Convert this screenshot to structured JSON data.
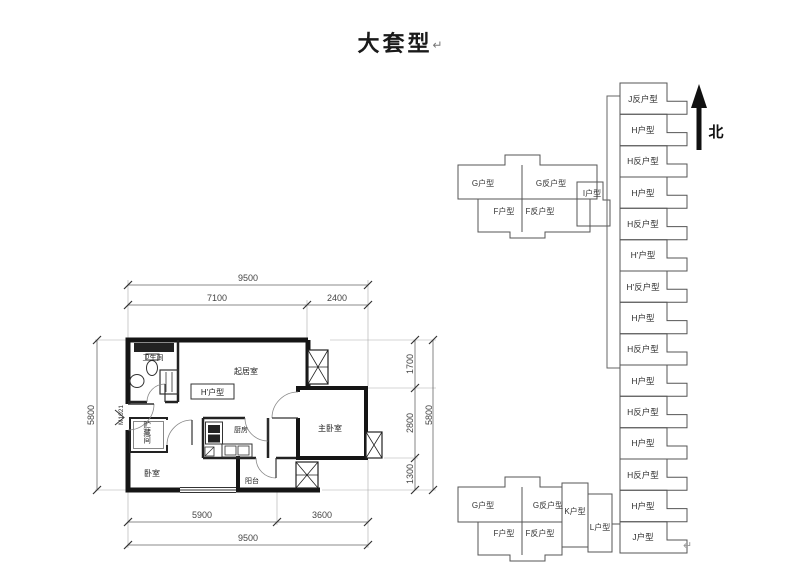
{
  "title": {
    "text": "大套型",
    "return_mark": "↵"
  },
  "floor_plan": {
    "unit_label": "H'户型",
    "door_code": "M1021",
    "rooms": {
      "bathroom": "卫生间",
      "living_room": "起居室",
      "storage": "贮藏间",
      "bedroom": "卧室",
      "kitchen": "厨房",
      "balcony": "阳台",
      "master_bedroom": "主卧室"
    },
    "dimensions": {
      "top_total": "9500",
      "top_left": "7100",
      "top_right": "2400",
      "left_total": "5800",
      "right_upper": "1700",
      "right_middle": "2800",
      "right_lower": "1300",
      "right_total": "5800",
      "bottom_left": "5900",
      "bottom_right": "3600",
      "bottom_total": "9500"
    }
  },
  "key_plan": {
    "north_label": "北",
    "upper_block": {
      "g": "G户型",
      "g_rev": "G反户型",
      "f": "F户型",
      "f_rev": "F反户型",
      "i": "I户型"
    },
    "lower_block": {
      "g": "G户型",
      "g_rev": "G反户型",
      "f": "F户型",
      "f_rev": "F反户型",
      "k": "K户型",
      "l": "L户型"
    },
    "strip": [
      "J反户型",
      "H户型",
      "H反户型",
      "H户型",
      "H反户型",
      "H'户型",
      "H'反户型",
      "H户型",
      "H反户型",
      "H户型",
      "H反户型",
      "H户型",
      "H反户型",
      "H户型",
      "J户型"
    ],
    "return_mark": "↵"
  },
  "style_colors": {
    "wall": "#1a1a1a",
    "thin_line": "#555",
    "dim_text": "#444"
  }
}
